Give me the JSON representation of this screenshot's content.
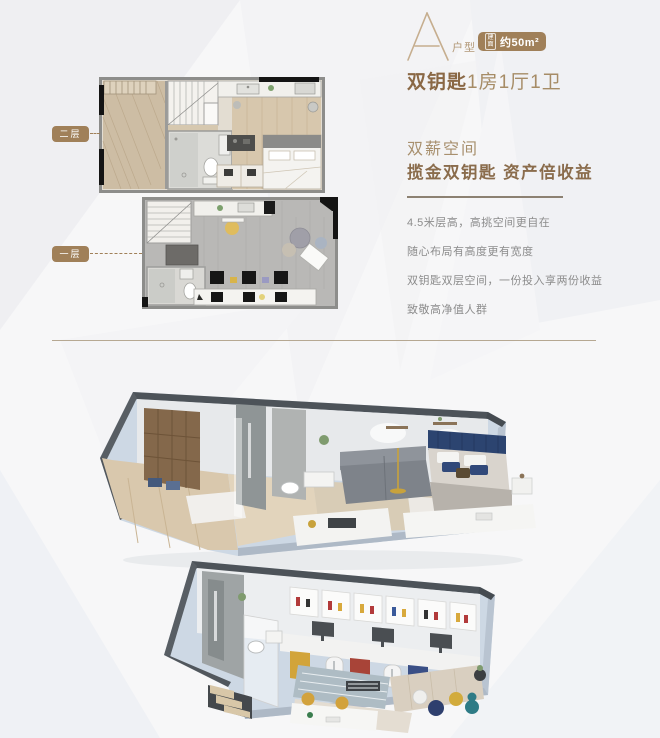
{
  "unit": {
    "letter": "A",
    "type_label": "户型",
    "area_badge_prefix": "建面",
    "area_badge_value": "约50m²",
    "title_strong": "双钥匙",
    "title_rest": "1房1厅1卫"
  },
  "selling": {
    "kicker": "双薪空间",
    "headline": "揽金双钥匙 资产倍收益",
    "lines": [
      "4.5米层高，高挑空间更自在",
      "随心布局有高度更有宽度",
      "双钥匙双层空间，一份投入享两份收益",
      "致敬高净值人群"
    ]
  },
  "floorplans": {
    "upper_label": "二层",
    "lower_label": "一层"
  },
  "colors": {
    "accent_brown": "#a08059",
    "title_brown": "#8a6845",
    "light_brown": "#a8906e",
    "body_gray": "#8c8c8c",
    "rule_brown": "#b6a892",
    "bed_headboard_navy": "#2c4470",
    "shell_blue": "#cdd8e4"
  }
}
